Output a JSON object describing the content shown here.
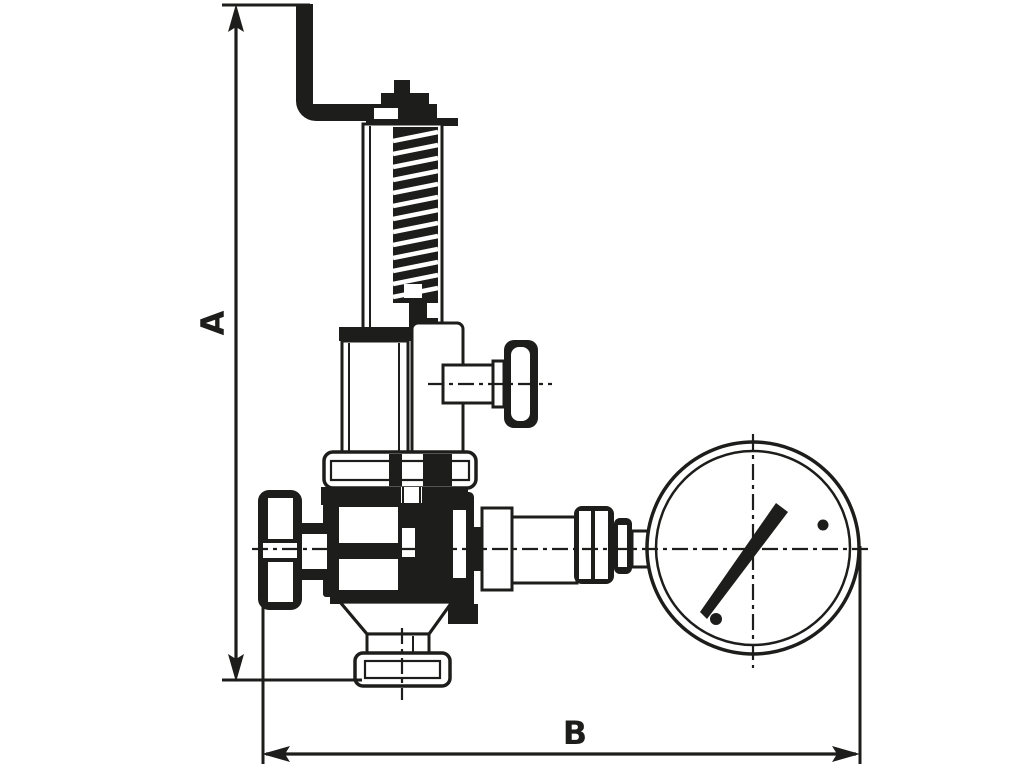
{
  "figure": {
    "kind": "technical-dimension-drawing",
    "subject": "relief-valve-with-pressure-gauge",
    "ink_color": "#1d1d1b",
    "background_color": "#ffffff",
    "dimension_a_label": "A",
    "dimension_b_label": "B"
  }
}
